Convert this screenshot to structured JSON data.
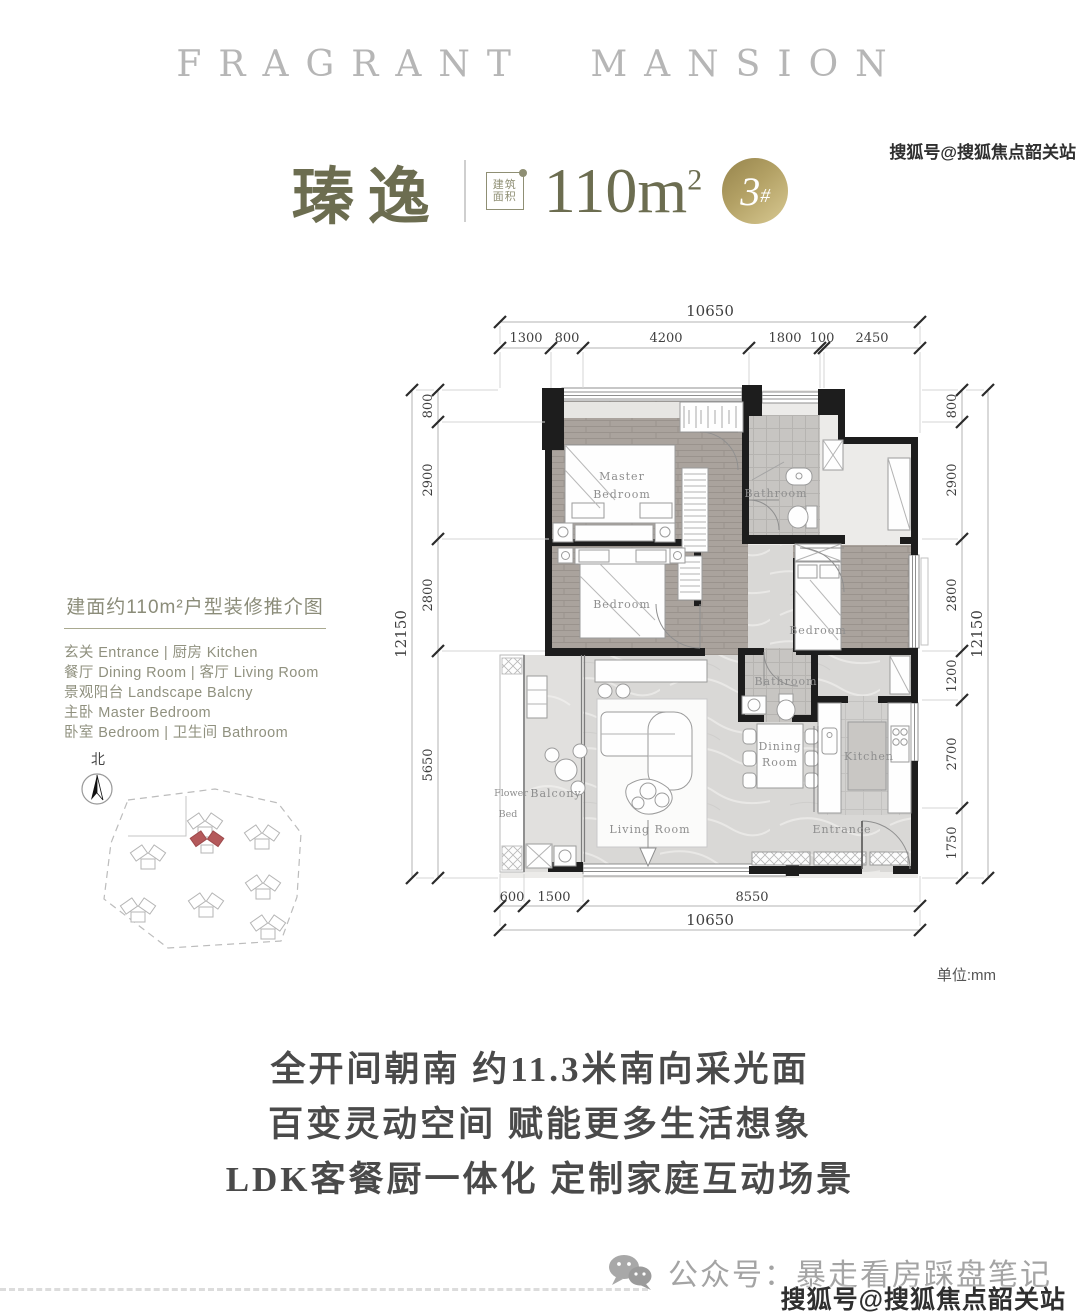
{
  "brand": "FRAGRANT MANSION",
  "title": {
    "name": "瑧逸",
    "stamp_line1": "建筑",
    "stamp_line2": "面积",
    "area": "110m",
    "area_sup": "2",
    "badge_num": "3",
    "badge_hash": "#"
  },
  "legend": {
    "title": "建面约110m²户型装修推介图",
    "rows": [
      "玄关 Entrance | 厨房 Kitchen",
      "餐厅 Dining Room | 客厅 Living Room",
      "景观阳台 Landscape Balcny",
      "主卧 Master Bedroom",
      "卧室 Bedroom | 卫生间 Bathroom"
    ]
  },
  "compass": {
    "north": "北"
  },
  "plan": {
    "unit_note": "单位:mm",
    "dims": {
      "top_total": "10650",
      "top_segments": [
        "1300",
        "800",
        "4200",
        "1800",
        "100",
        "2450"
      ],
      "left_total": "12150",
      "left_segments": [
        "800",
        "2900",
        "2800",
        "5650"
      ],
      "right_total": "12150",
      "right_segments": [
        "800",
        "2900",
        "2800",
        "1200",
        "2700",
        "1750"
      ],
      "bottom_segments": [
        "600",
        "1500",
        "8550"
      ],
      "bottom_total": "10650"
    },
    "rooms": {
      "master1": "Master",
      "master2": "Bedroom",
      "bedroom2": "Bedroom",
      "bathroom1": "Bathroom",
      "bedroom3": "Bedroom",
      "bathroom2": "Bathroom",
      "dining1": "Dining",
      "dining2": "Room",
      "kitchen": "Kitchen",
      "living": "Living Room",
      "balcony": "Balcony",
      "flower1": "Flower",
      "flower2": "Bed",
      "entrance": "Entrance"
    }
  },
  "slogans": [
    "全开间朝南 约11.3米南向采光面",
    "百变灵动空间 赋能更多生活想象",
    "LDK客餐厨一体化 定制家庭互动场景"
  ],
  "footer": {
    "wechat": "公众号：暴走看房踩盘笔记"
  },
  "watermark": {
    "top": "搜狐号@搜狐焦点韶关站",
    "bottom": "搜狐号@搜狐焦点韶关站"
  }
}
